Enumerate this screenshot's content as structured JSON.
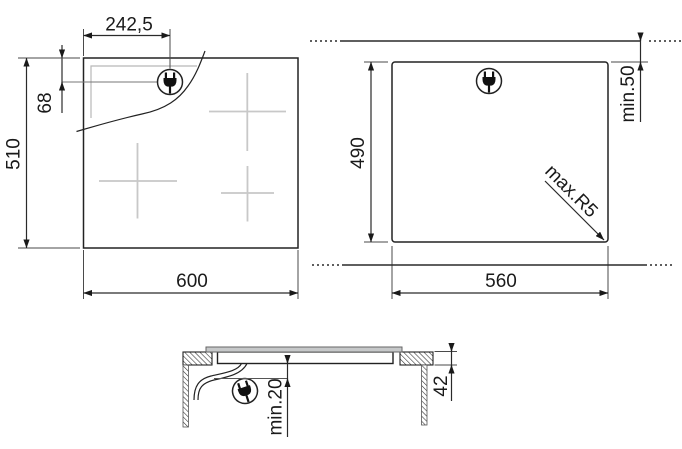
{
  "drawing": {
    "title": "Hob installation dimensions diagram",
    "labels": {
      "top_view": {
        "plug_offset_x": "242,5",
        "plug_offset_y": "68",
        "depth": "510",
        "width": "600"
      },
      "cutout_view": {
        "depth": "490",
        "wall_clearance": "min.50",
        "corner_radius": "max.R5",
        "width": "560"
      },
      "side_view": {
        "bottom_clearance": "min.20",
        "body_height": "42"
      }
    },
    "icons": {
      "plug": "power-plug-icon"
    },
    "colors": {
      "line": "#222222",
      "secondary_line": "#b8b8b8",
      "zone_cross": "#c8c8c8",
      "glass_fill": "#c6c8c9",
      "background": "#ffffff"
    }
  }
}
